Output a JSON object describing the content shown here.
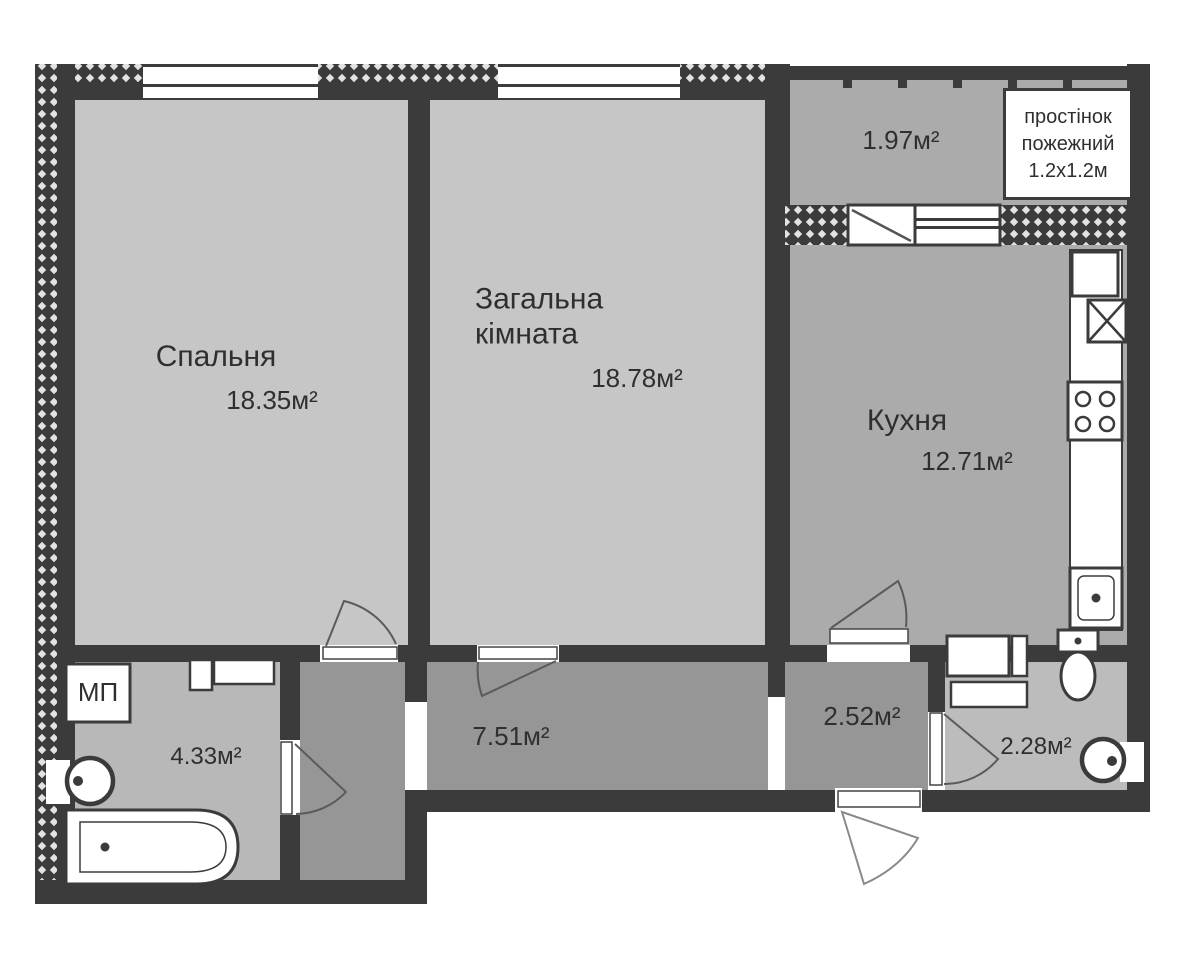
{
  "floorplan": {
    "title": "2-room apartment floor plan",
    "rooms": {
      "bedroom": {
        "name": "Спальня",
        "area": "18.35м²"
      },
      "living": {
        "name": "Загальна кімната",
        "area": "18.78м²"
      },
      "kitchen": {
        "name": "Кухня",
        "area": "12.71м²"
      },
      "balcony": {
        "area": "1.97м²"
      },
      "hallway": {
        "area": "7.51м²"
      },
      "bathroom": {
        "area": "4.33м²"
      },
      "entry": {
        "area": "2.52м²"
      },
      "wc": {
        "area": "2.28м²"
      }
    },
    "labels": {
      "washing_machine": "МП",
      "fire_partition": [
        "простінок",
        "пожежний",
        "1.2х1.2м"
      ]
    },
    "colors": {
      "wall": "#3b3b3b",
      "hatch_light": "#e3e3e3",
      "room_light": "#c6c6c6",
      "room_medium": "#ababab",
      "room_dark": "#969696",
      "bathroom_fill": "#b8b8b8",
      "wc_fill": "#bcbcbc",
      "fixture_fill": "#ffffff",
      "outside": "#ffffff",
      "text": "#2f2f2f"
    }
  }
}
